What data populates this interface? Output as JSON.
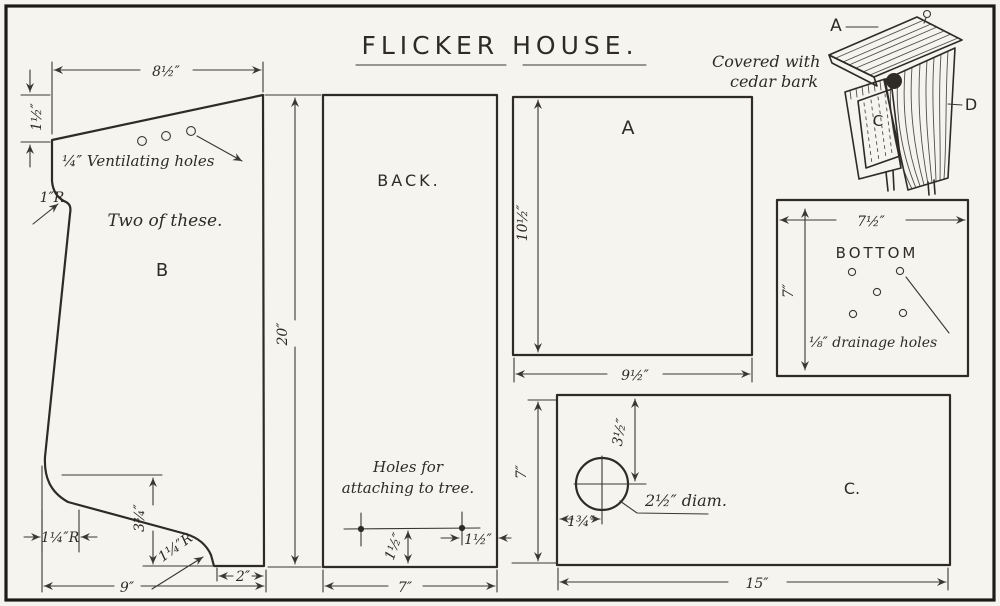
{
  "title": "FLICKER HOUSE.",
  "perspective": {
    "label_a": "A",
    "label_c": "C",
    "label_d": "D",
    "caption1": "Covered with",
    "caption2": "cedar bark"
  },
  "piece_b": {
    "label": "B",
    "note": "Two of these.",
    "vent_label": "¼″ Ventilating holes",
    "radius_top": "1″R",
    "width_top": "8½″",
    "height_left": "1½″",
    "width_bottom": "9″",
    "tab_width": "2″",
    "curve_height": "3¾″",
    "radius_left": "1¼″R",
    "radius_bottom": "1¼″R"
  },
  "back": {
    "label": "BACK.",
    "height": "20″",
    "width": "7″",
    "note1": "Holes for",
    "note2": "attaching to tree.",
    "hole_offset_v": "1½″",
    "hole_offset_h": "1½″"
  },
  "panel_a": {
    "label": "A",
    "height": "10½″",
    "width": "9½″"
  },
  "bottom": {
    "label": "BOTTOM",
    "width": "7½″",
    "height": "7″",
    "drain_note": "⅛″ drainage holes"
  },
  "panel_c": {
    "label": "C.",
    "width": "15″",
    "height": "7″",
    "hole_from_top": "3½″",
    "hole_from_left": "1¾″",
    "hole_diam": "2½″ diam."
  }
}
